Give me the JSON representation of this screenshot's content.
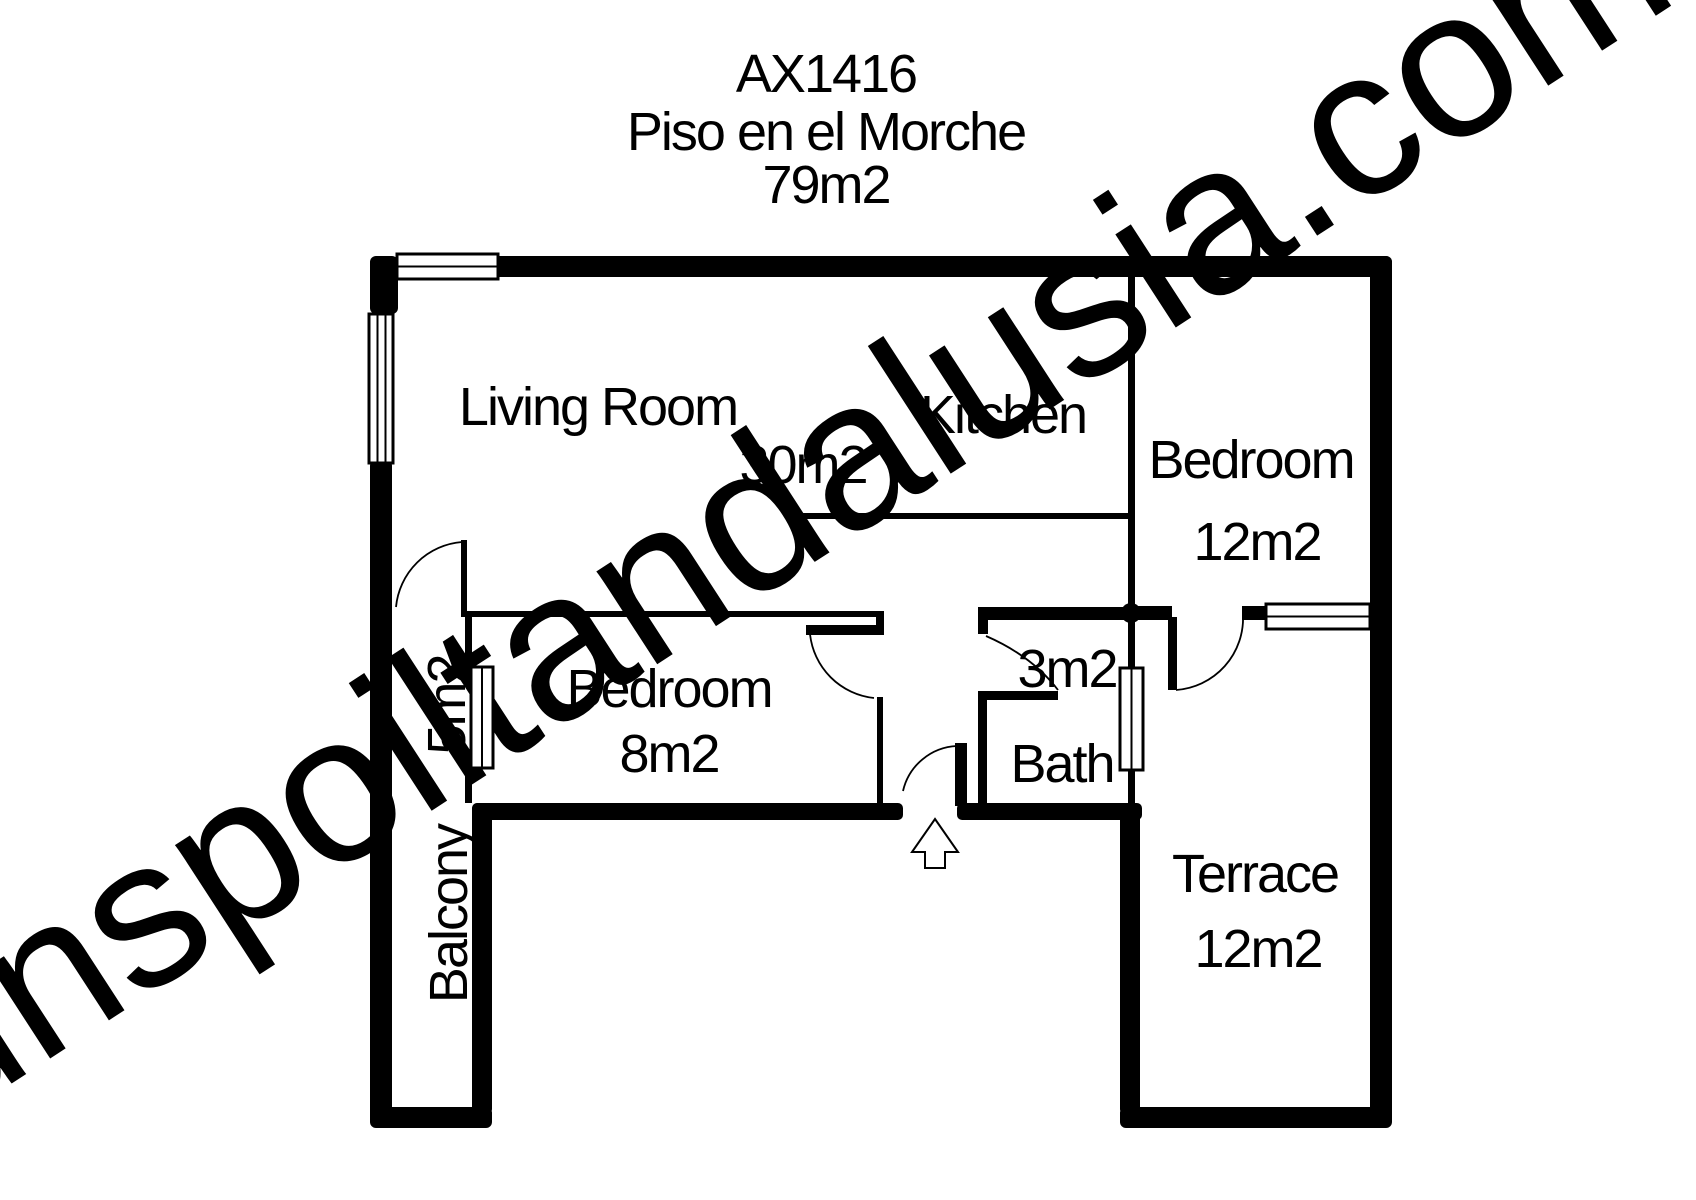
{
  "title": {
    "code": "AX1416",
    "name": "Piso en el Morche",
    "total_area": "79m2"
  },
  "watermark": "unspoiltandalusia.com",
  "rooms": {
    "living_room": {
      "name": "Living Room",
      "area": "30m2"
    },
    "kitchen": {
      "name": "Kitchen"
    },
    "bedroom_1": {
      "name": "Bedroom",
      "area": "12m2"
    },
    "bedroom_2": {
      "name": "Bedroom",
      "area": "8m2"
    },
    "hall": {
      "area": "3m2"
    },
    "bath": {
      "name": "Bath"
    },
    "balcony": {
      "name": "Balcony",
      "area": "5m2"
    },
    "terrace": {
      "name": "Terrace",
      "area": "12m2"
    }
  },
  "colors": {
    "wall": "#000000",
    "background": "#ffffff",
    "watermark": "#d9d9d9"
  }
}
